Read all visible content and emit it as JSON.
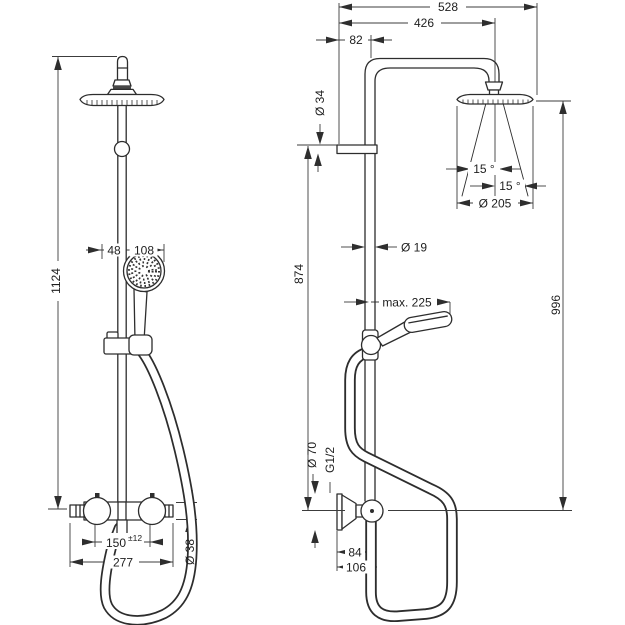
{
  "drawing": {
    "front_view": {
      "overall_height": "1124",
      "hand_shower_offset": "48",
      "hand_shower_width": "108",
      "inlet_spacing": "150",
      "inlet_tolerance": "±12",
      "valve_width": "277",
      "valve_diameter": "Ø 38"
    },
    "side_view": {
      "reach_total": "528",
      "reach_arm": "426",
      "wall_offset": "82",
      "arm_diameter": "Ø 34",
      "spray_angle_inner": "15 °",
      "spray_angle_outer": "15 °",
      "head_diameter": "Ø 205",
      "pipe_diameter": "Ø 19",
      "hand_shower_reach": "max. 225",
      "wall_bracket_height": "874",
      "head_drop_height": "996",
      "flange_diameter": "Ø 70",
      "connection_thread": "G1/2",
      "hose_offset_near": "84",
      "hose_offset_far": "106"
    }
  }
}
